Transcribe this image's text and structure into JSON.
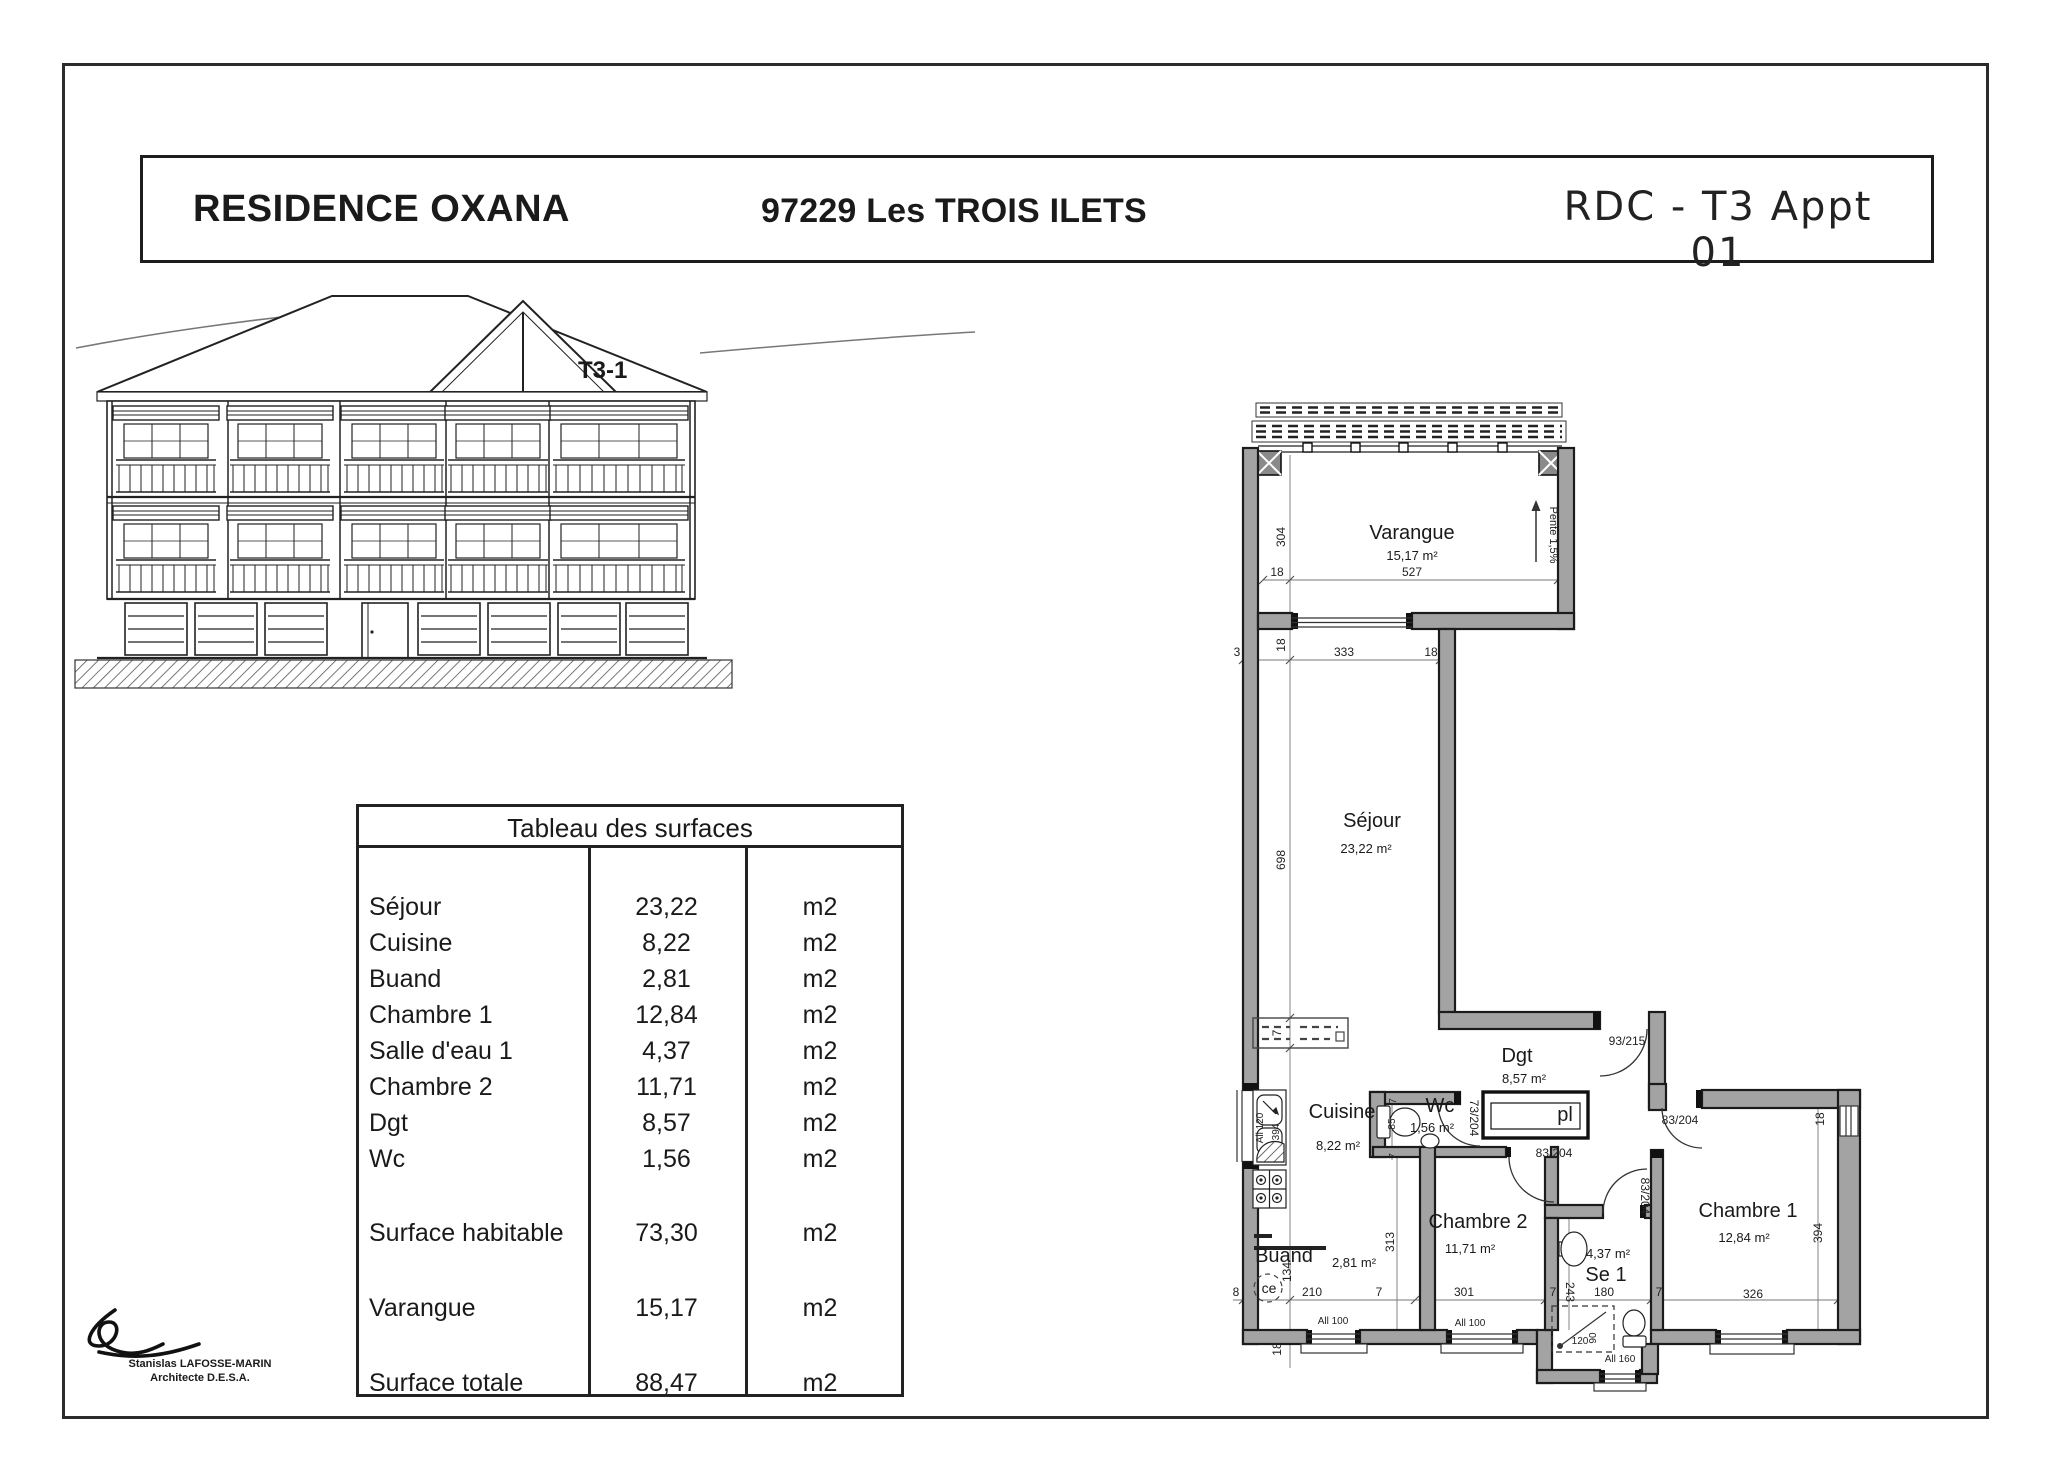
{
  "header": {
    "residence": "RESIDENCE OXANA",
    "address": "97229 Les TROIS ILETS",
    "plan_ref": "RDC - T3 Appt 01"
  },
  "elevation": {
    "unit_label": "T3-1"
  },
  "surface_table": {
    "title": "Tableau des surfaces",
    "unit": "m2",
    "rows": [
      {
        "label": "Séjour",
        "value": "23,22"
      },
      {
        "label": "Cuisine",
        "value": "8,22"
      },
      {
        "label": "Buand",
        "value": "2,81"
      },
      {
        "label": "Chambre 1",
        "value": "12,84"
      },
      {
        "label": "Salle d'eau 1",
        "value": "4,37"
      },
      {
        "label": "Chambre 2",
        "value": "11,71"
      },
      {
        "label": "Dgt",
        "value": "8,57"
      },
      {
        "label": "Wc",
        "value": "1,56"
      }
    ],
    "summary_rows": [
      {
        "label": "Surface habitable",
        "value": "73,30"
      },
      {
        "label": "Varangue",
        "value": "15,17"
      },
      {
        "label": "Surface totale",
        "value": "88,47"
      }
    ]
  },
  "floorplan": {
    "rooms": {
      "varangue": {
        "name": "Varangue",
        "area": "15,17 m²"
      },
      "sejour": {
        "name": "Séjour",
        "area": "23,22 m²"
      },
      "cuisine": {
        "name": "Cuisine",
        "area": "8,22 m²"
      },
      "wc": {
        "name": "Wc",
        "area": "1,56 m²"
      },
      "dgt": {
        "name": "Dgt",
        "area": "8,57 m²"
      },
      "chambre2": {
        "name": "Chambre 2",
        "area": "11,71 m²"
      },
      "chambre1": {
        "name": "Chambre 1",
        "area": "12,84 m²"
      },
      "se1": {
        "name": "Se 1",
        "area": "4,37 m²"
      },
      "buand": {
        "name": "Buand",
        "area": "2,81 m²"
      }
    },
    "closet_label": "pl",
    "water_heater_label": "ce",
    "slope_label": "Pente 1,5%",
    "door_sizes": {
      "d93": "93/215",
      "d83": "83/204",
      "d73": "73/204"
    },
    "dims": {
      "n304": "304",
      "n18": "18",
      "n527": "527",
      "n3": "3",
      "n333": "333",
      "n698": "698",
      "n7": "7",
      "n85": "85",
      "n313": "313",
      "n134": "134",
      "n8": "8",
      "n210": "210",
      "n301": "301",
      "n180": "180",
      "n326": "326",
      "n120": "120",
      "n90": "90",
      "n243": "243",
      "n394": "394",
      "all100": "All 100",
      "all120": "All 120",
      "all160": "All 160"
    }
  },
  "signature": {
    "name": "Stanislas LAFOSSE-MARIN",
    "title": "Architecte D.E.S.A."
  }
}
